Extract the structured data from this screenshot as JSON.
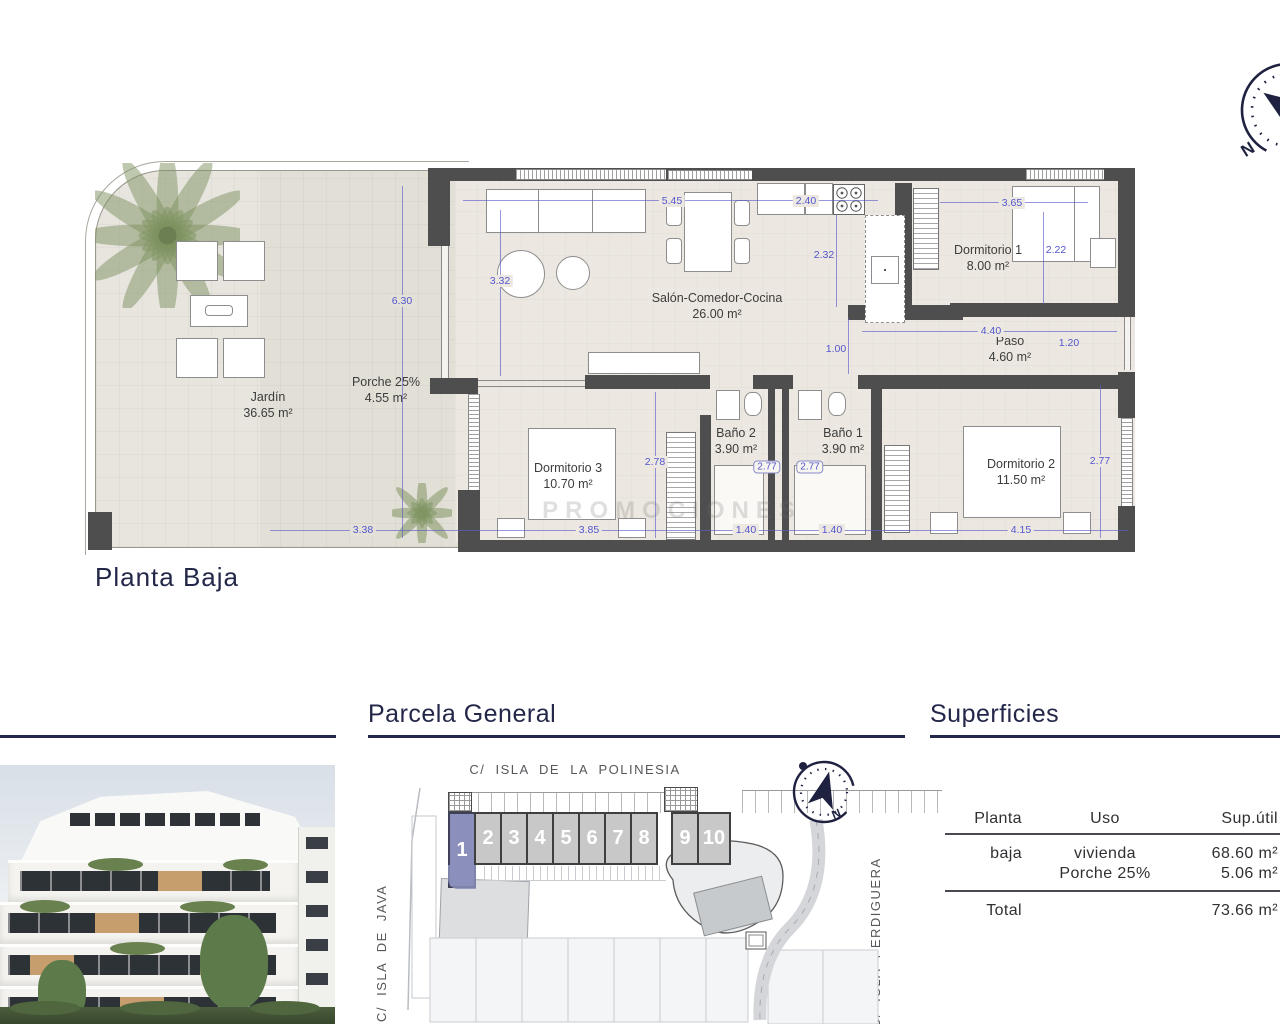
{
  "page_title": "Planta Baja",
  "watermark": "PROMOCIONES",
  "rooms": {
    "jardin": {
      "name": "Jardín",
      "area": "36.65 m²"
    },
    "porche": {
      "name": "Porche 25%",
      "area": "4.55 m²"
    },
    "salon": {
      "name": "Salón-Comedor-Cocina",
      "area": "26.00 m²"
    },
    "dormitorio1": {
      "name": "Dormitorio 1",
      "area": "8.00 m²"
    },
    "dormitorio2": {
      "name": "Dormitorio 2",
      "area": "11.50 m²"
    },
    "dormitorio3": {
      "name": "Dormitorio 3",
      "area": "10.70 m²"
    },
    "bano1": {
      "name": "Baño 1",
      "area": "3.90 m²"
    },
    "bano2": {
      "name": "Baño 2",
      "area": "3.90 m²"
    },
    "paso": {
      "name": "Paso",
      "area": "4.60 m²"
    }
  },
  "dims": {
    "d545": "5.45",
    "d240": "2.40",
    "d365": "3.65",
    "d332": "3.32",
    "d232": "2.32",
    "d222": "2.22",
    "d630": "6.30",
    "d440": "4.40",
    "d120": "1.20",
    "d100": "1.00",
    "d278": "2.78",
    "d277a": "2.77",
    "d277b": "2.77",
    "d277c": "2.77",
    "d338": "3.38",
    "d385": "3.85",
    "d140a": "1.40",
    "d140b": "1.40",
    "d415": "4.15"
  },
  "compass": {
    "north": "N"
  },
  "parcela": {
    "title": "Parcela General",
    "street_top": "C/ ISLA DE LA POLINESIA",
    "street_left": "C/ ISLA DE JAVA",
    "street_right": "C/ ISLA PERDIGUERA",
    "units": [
      "1",
      "2",
      "3",
      "4",
      "5",
      "6",
      "7",
      "8",
      "9",
      "10"
    ],
    "highlighted_unit": "1"
  },
  "superficies": {
    "title": "Superficies",
    "col_planta": "Planta",
    "col_uso": "Uso",
    "col_sup": "Sup.útil",
    "row1": {
      "planta": "baja",
      "uso": "vivienda",
      "sup": "68.60 m²"
    },
    "row2": {
      "uso": "Porche 25%",
      "sup": "5.06 m²"
    },
    "total_label": "Total",
    "total_value": "73.66 m²"
  },
  "colors": {
    "navy": "#232749",
    "dimension_blue": "#5356cd",
    "wall_gray": "#4e4e4e",
    "unit_highlight": "#8a8fbc"
  }
}
